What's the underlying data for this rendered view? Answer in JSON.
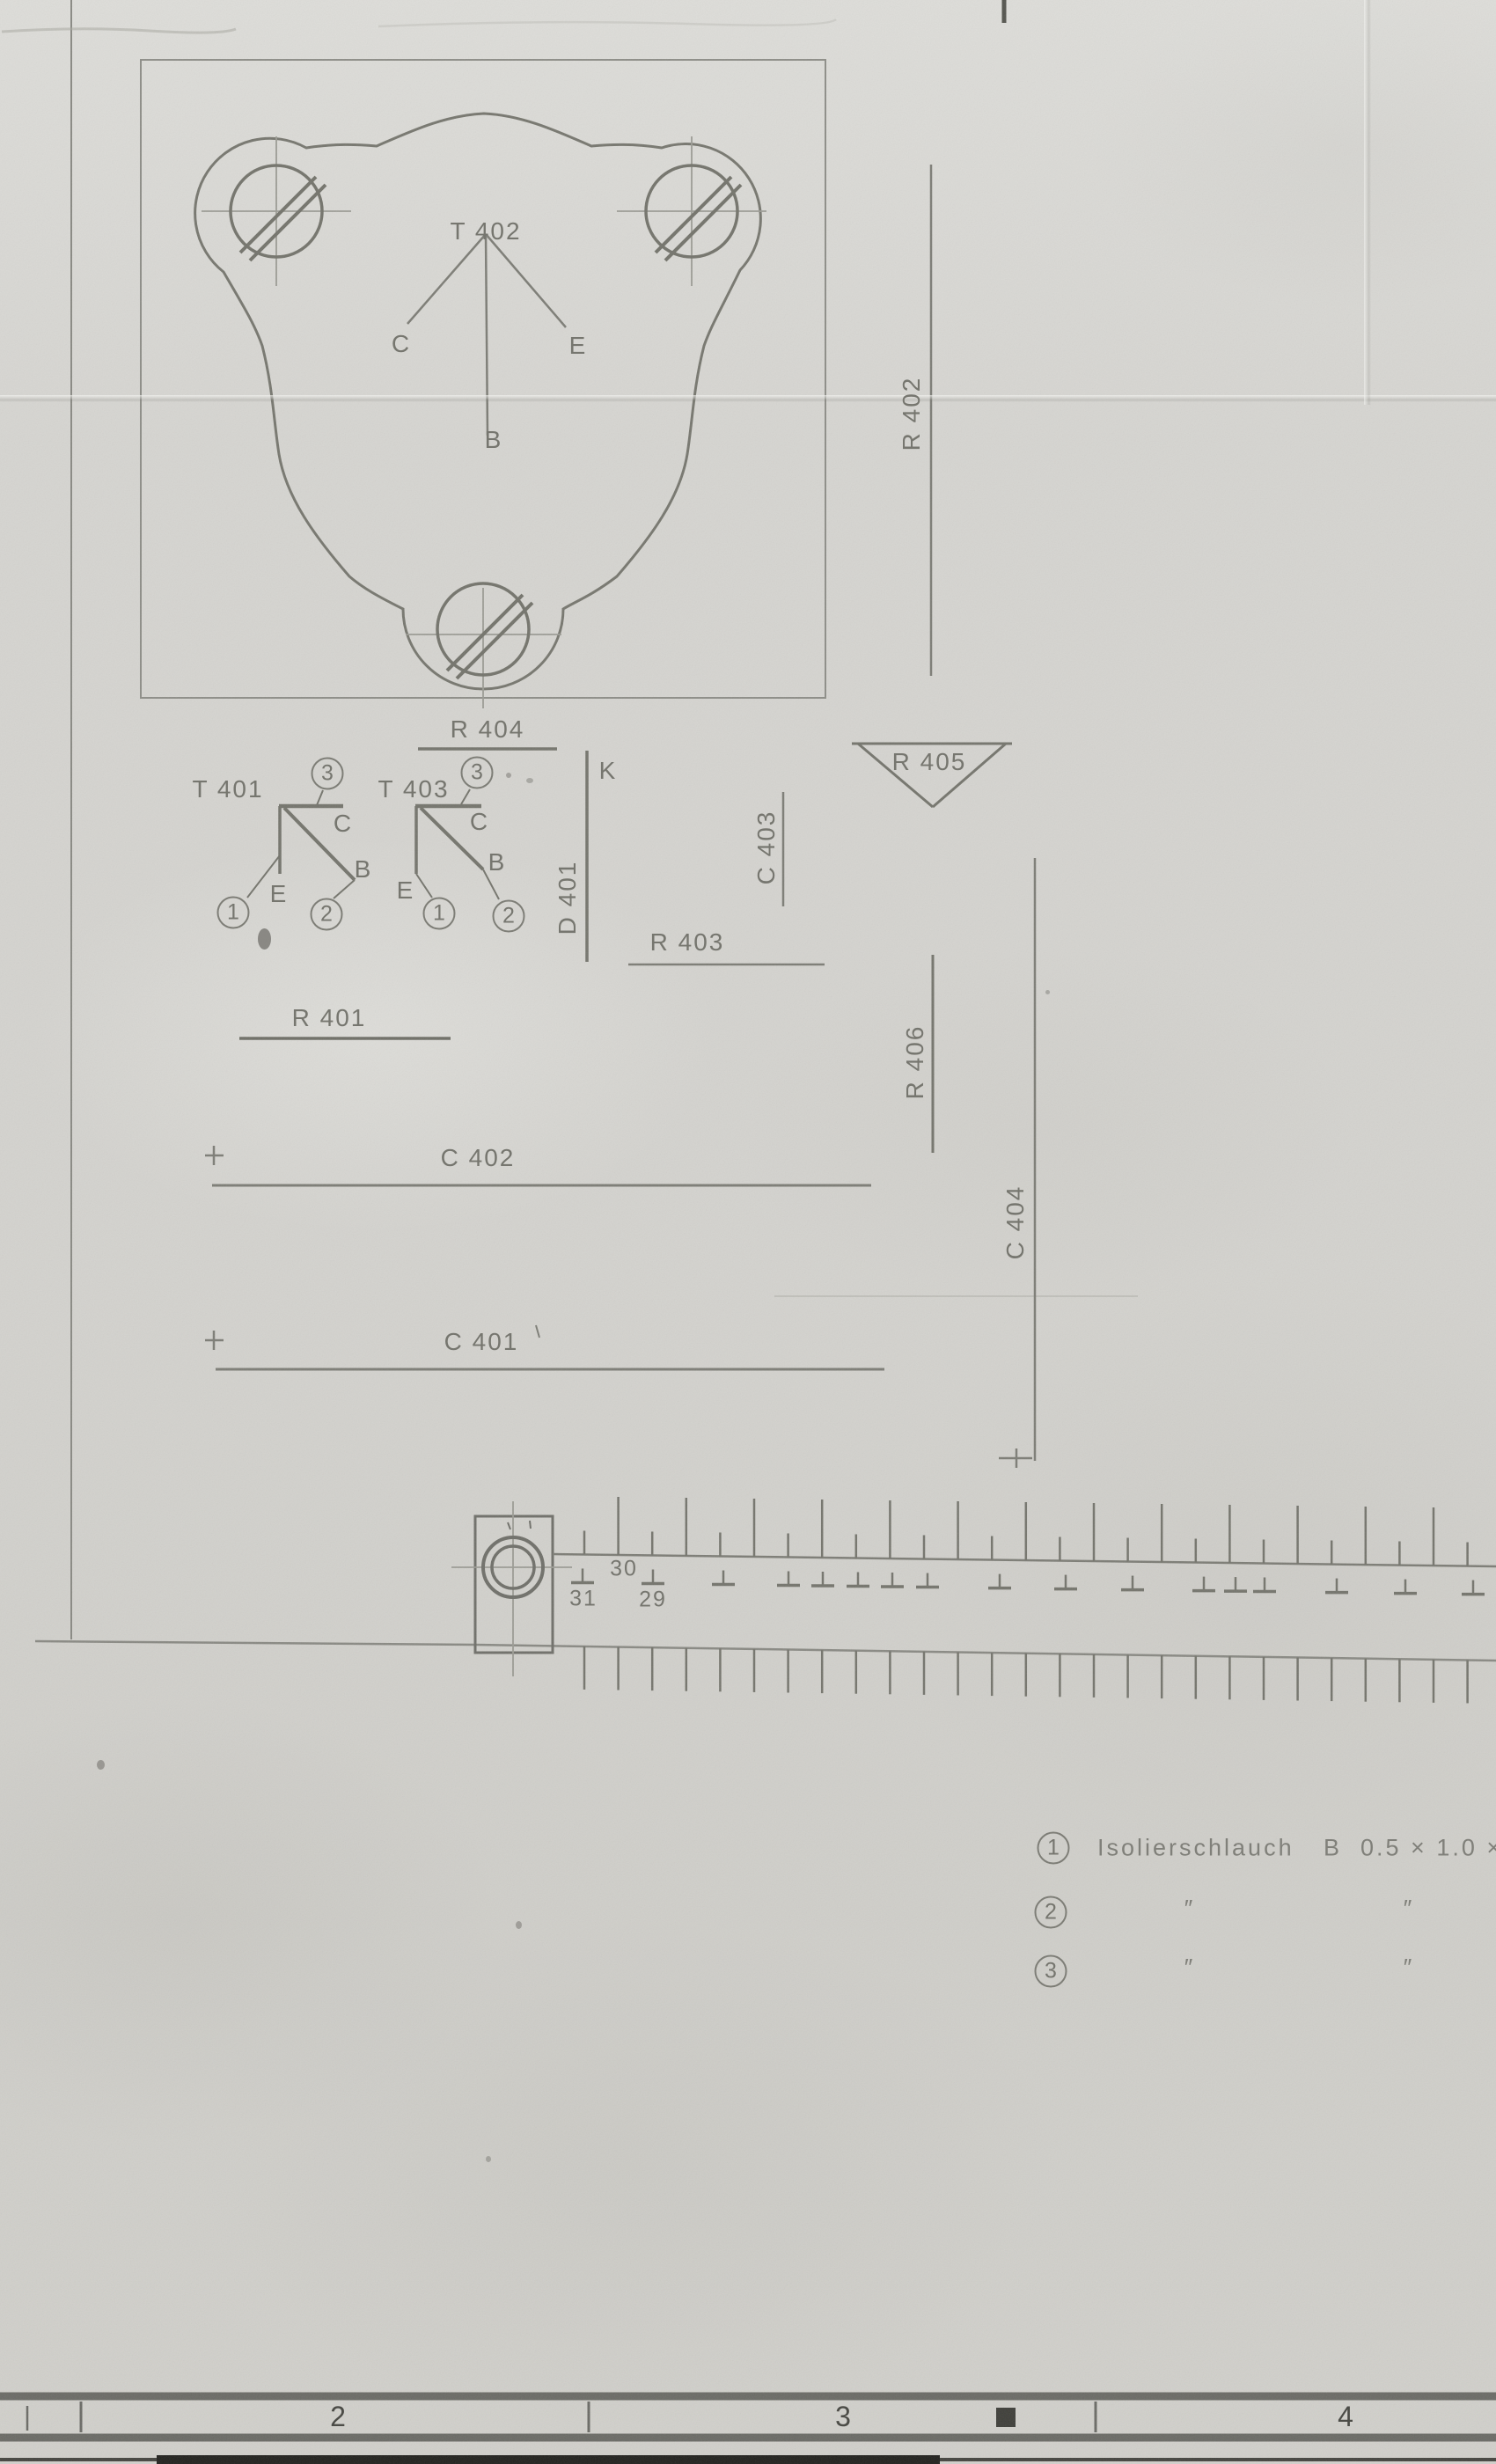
{
  "sheet": {
    "plate_view": {
      "ref": "T 402",
      "pin_c": "C",
      "pin_e": "E",
      "pin_b": "B"
    },
    "transistor_t401": {
      "ref": "T 401",
      "pin1": "1",
      "pin2": "2",
      "pin3": "3",
      "pc": "C",
      "pe": "E",
      "pb": "B"
    },
    "transistor_t403": {
      "ref": "T 403",
      "pin1": "1",
      "pin2": "2",
      "pin3": "3",
      "pc": "C",
      "pe": "E",
      "pb": "B"
    },
    "refs": {
      "r401": "R 401",
      "r402": "R 402",
      "r403": "R 403",
      "r404": "R 404",
      "r405": "R 405",
      "r406": "R 406",
      "c401": "C 401",
      "c402": "C 402",
      "c403": "C 403",
      "c404": "C 404",
      "d401": "D 401",
      "k": "K"
    },
    "ruler": {
      "n31": "31",
      "n30": "30",
      "n29": "29"
    },
    "parts": {
      "rows": [
        {
          "num": "1",
          "name": "Isolierschlauch",
          "spec": "B  0.5 × 1.0 ×"
        },
        {
          "num": "2",
          "d1": "″",
          "d2": "″"
        },
        {
          "num": "3",
          "d1": "″",
          "d2": "″"
        }
      ]
    },
    "bottom_scale": {
      "n2": "2",
      "n3": "3",
      "n4": "4"
    }
  },
  "colors": {
    "paper": "#d6d5d1",
    "line": "#7d7d78",
    "text": "#76766f",
    "scale_dark": "#4c4c47",
    "bar_black": "#23231f"
  }
}
